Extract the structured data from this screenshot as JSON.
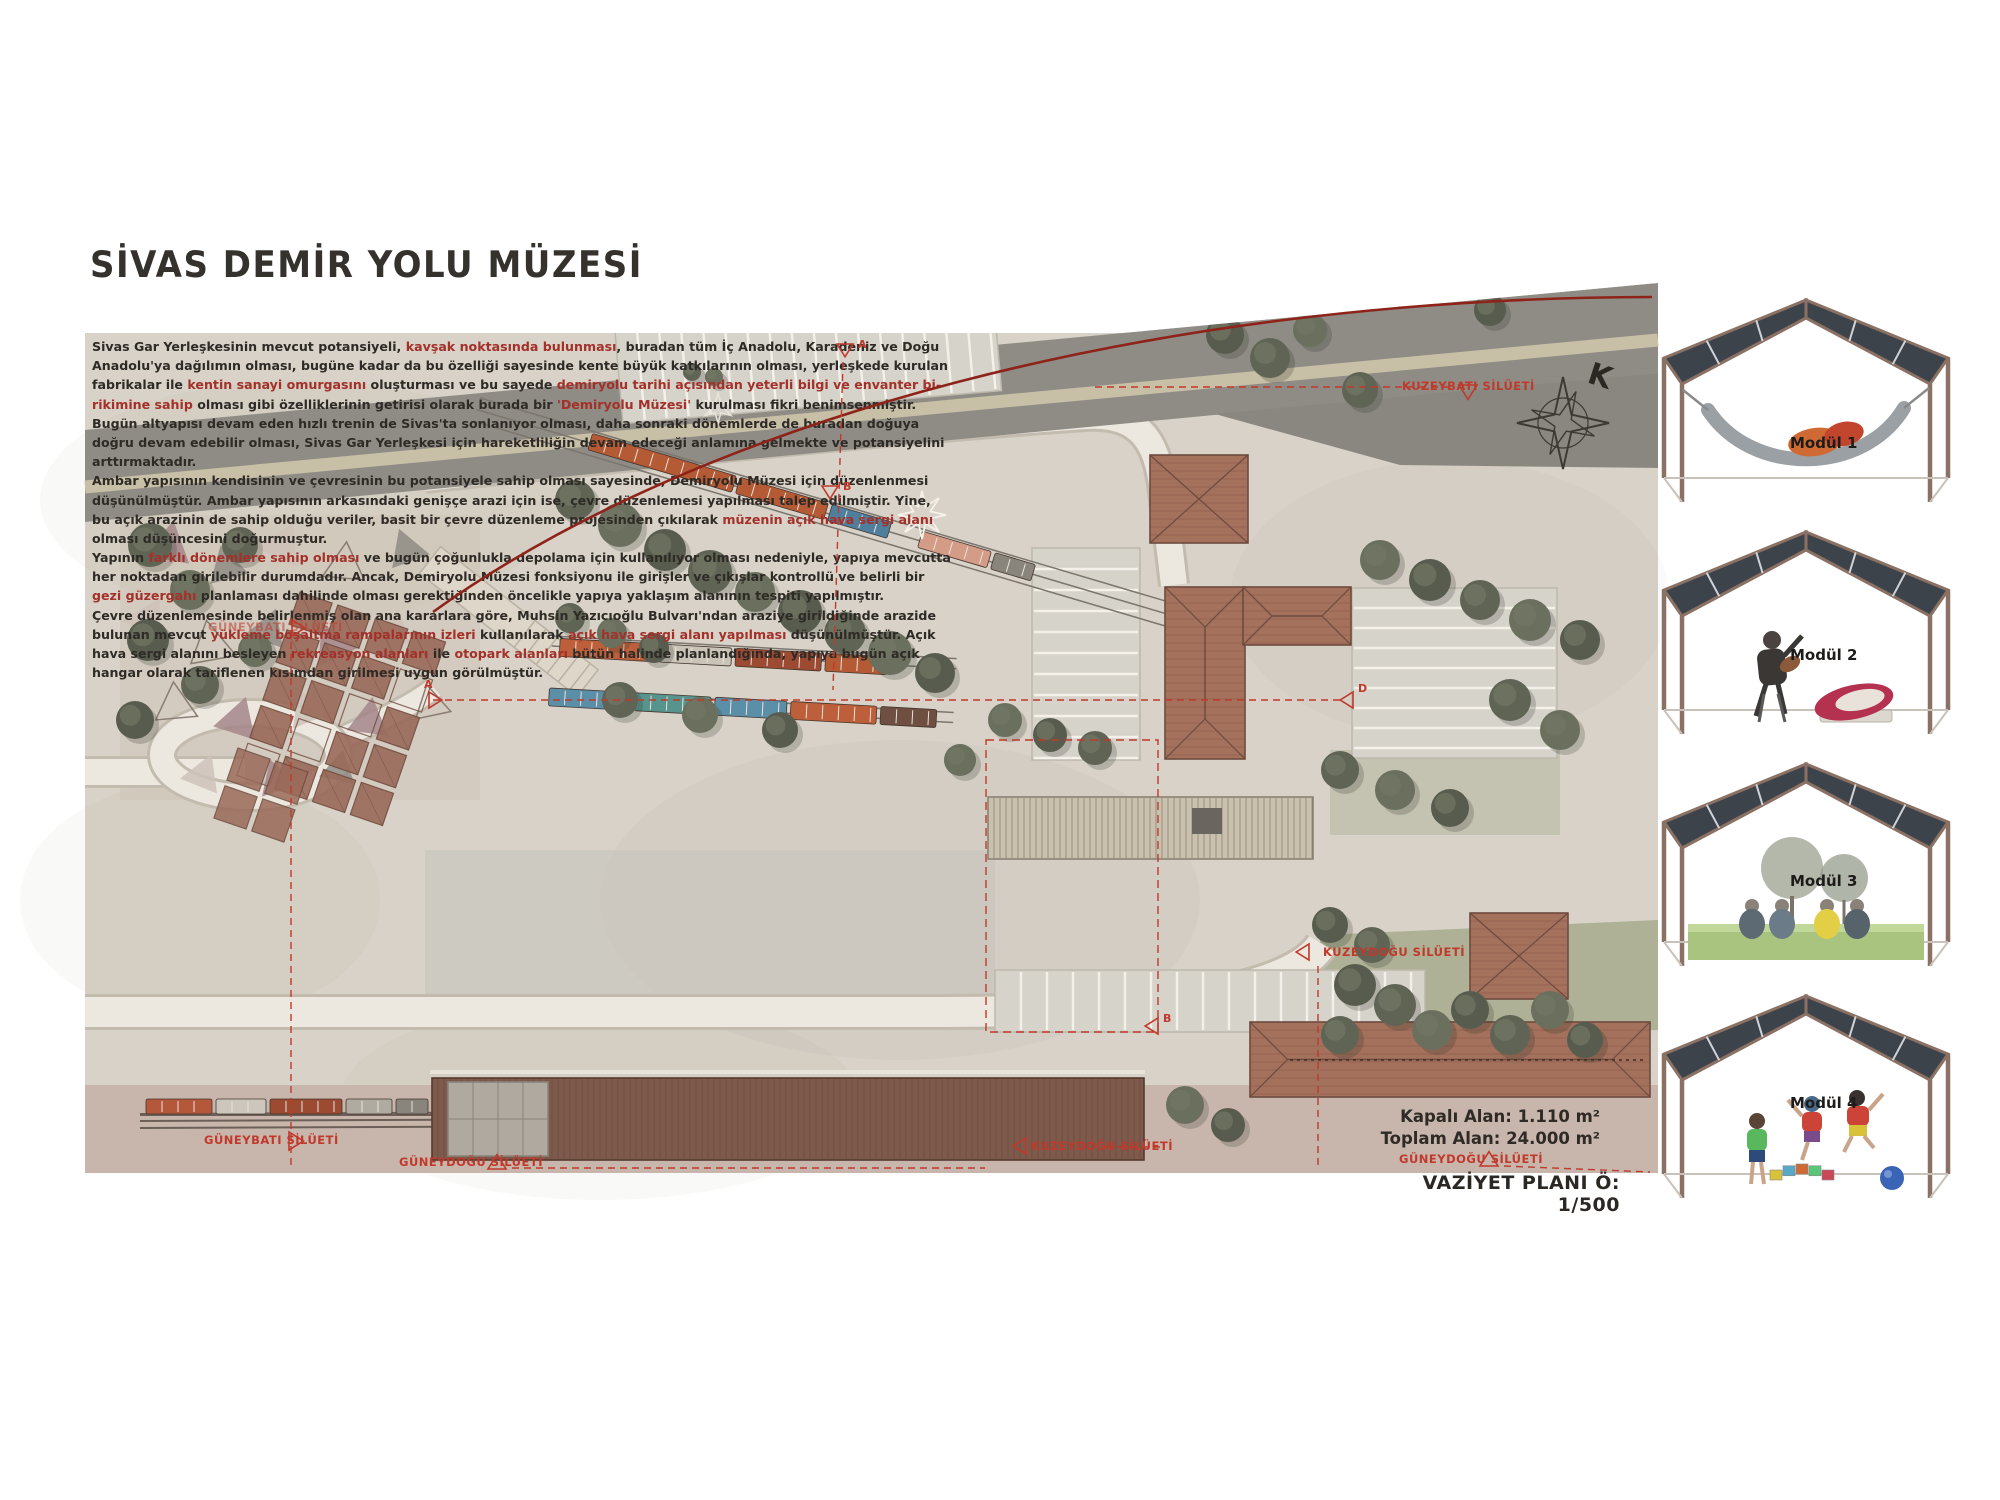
{
  "page": {
    "title": "SİVAS DEMİR YOLU MÜZESİ"
  },
  "colors": {
    "paper": "#d8d2c8",
    "road_dark": "#8f8c85",
    "road_light": "#ece8e0",
    "annotation_red": "#c0392b",
    "curve_red": "#8e231a",
    "text_red": "#a33029",
    "text_black": "#2e2a26",
    "roof_brown": "#a4715c",
    "tree_green": "#5f6455"
  },
  "intro": {
    "lines": [
      [
        {
          "t": "Sivas Gar Yerleşkesinin mevcut potansiyeli, ",
          "red": false
        },
        {
          "t": "kavşak noktasında bulunması",
          "red": true
        },
        {
          "t": ", buradan tüm İç Anadolu, Karadeniz ve Doğu",
          "red": false
        }
      ],
      [
        {
          "t": "Anadolu'ya dağılımın olması, bugüne kadar da bu özelliği sayesinde kente büyük katkılarının olması, yerleşkede kurulan",
          "red": false
        }
      ],
      [
        {
          "t": "fabrikalar ile ",
          "red": false
        },
        {
          "t": "kentin sanayi omurgasını",
          "red": true
        },
        {
          "t": " oluşturması ve bu sayede ",
          "red": false
        },
        {
          "t": "demiryolu tarihi açısından yeterli bilgi ve envanter bi-",
          "red": true
        }
      ],
      [
        {
          "t": "rikimine sahip",
          "red": true
        },
        {
          "t": " olması gibi özelliklerinin getirisi olarak burada bir ",
          "red": false
        },
        {
          "t": "'Demiryolu Müzesi'",
          "red": true
        },
        {
          "t": " kurulması fikri benimsenmiştir.",
          "red": false
        }
      ],
      [
        {
          "t": "Bugün altyapısı devam eden hızlı trenin de Sivas'ta sonlanıyor olması, daha sonraki dönemlerde de buradan doğuya",
          "red": false
        }
      ],
      [
        {
          "t": "doğru devam edebilir olması, Sivas Gar Yerleşkesi için hareketliliğin devam edeceği anlamına gelmekte ve potansiyelini",
          "red": false
        }
      ],
      [
        {
          "t": "arttırmaktadır.",
          "red": false
        }
      ],
      [
        {
          "t": "Ambar yapısının kendisinin ve çevresinin bu potansiyele sahip olması sayesinde, Demiryolu Müzesi için düzenlenmesi",
          "red": false
        }
      ],
      [
        {
          "t": "düşünülmüştür. Ambar yapısının arkasındaki genişçe arazi için ise, çevre düzenlemesi yapılması talep edilmiştir. Yine,",
          "red": false
        }
      ],
      [
        {
          "t": "bu açık arazinin de sahip olduğu veriler, basit bir çevre düzenleme projesinden çıkılarak ",
          "red": false
        },
        {
          "t": "müzenin açık hava sergi alanı",
          "red": true
        }
      ],
      [
        {
          "t": "olması düşüncesini doğurmuştur.",
          "red": false
        }
      ],
      [
        {
          "t": "Yapının ",
          "red": false
        },
        {
          "t": "farklı dönemlere sahip olması",
          "red": true
        },
        {
          "t": " ve bugün çoğunlukla depolama için kullanılıyor olması nedeniyle, yapıya mevcutta",
          "red": false
        }
      ],
      [
        {
          "t": "her noktadan girilebilir durumdadır. Ancak, Demiryolu Müzesi fonksiyonu ile girişler ve çıkışlar kontrollü ve belirli bir",
          "red": false
        }
      ],
      [
        {
          "t": "gezi güzergahı",
          "red": true
        },
        {
          "t": " planlaması dahilinde olması gerektiğinden öncelikle yapıya yaklaşım alanının tespiti yapılmıştır.",
          "red": false
        }
      ],
      [
        {
          "t": "Çevre düzenlemesinde belirlenmiş olan ana kararlara göre, Muhsin Yazıcıoğlu Bulvarı'ndan araziye girildiğinde arazide",
          "red": false
        }
      ],
      [
        {
          "t": "bulunan mevcut ",
          "red": false
        },
        {
          "t": "yükleme boşaltma rampalarının izleri",
          "red": true
        },
        {
          "t": " kullanılarak ",
          "red": false
        },
        {
          "t": "açık hava sergi alanı yapılması",
          "red": true
        },
        {
          "t": " düşünülmüştür. Açık",
          "red": false
        }
      ],
      [
        {
          "t": "hava sergi alanını besleyen ",
          "red": false
        },
        {
          "t": "rekreasyon alanları",
          "red": true
        },
        {
          "t": " ile ",
          "red": false
        },
        {
          "t": "otopark alanları",
          "red": true
        },
        {
          "t": " bütün halinde planlandığında, yapıya bugün açık",
          "red": false
        }
      ],
      [
        {
          "t": "hangar olarak tariflenen kısımdan girilmesi uygun görülmüştür.",
          "red": false
        }
      ]
    ]
  },
  "plan": {
    "compass_letter": "K",
    "silhouette_labels": {
      "kuzeybati": "KUZEYBATI SİLÜETİ",
      "guneybati": "GÜNEYBATI SİLÜETİ",
      "guneydogu": "GÜNEYDOĞU SİLÜETİ",
      "kuzeydogu": "KUZEYDOĞU SİLÜETİ"
    },
    "section_letters": [
      "A",
      "B",
      "D"
    ],
    "stats": [
      {
        "label": "Kapalı Alan:",
        "value": "1.110 m²"
      },
      {
        "label": "Toplam Alan:",
        "value": "24.000 m²"
      }
    ],
    "scale_note": "VAZİYET PLANI Ö: 1/500"
  },
  "modules": [
    {
      "label": "Modül 1",
      "scene": "hammock"
    },
    {
      "label": "Modül 2",
      "scene": "musician"
    },
    {
      "label": "Modül 3",
      "scene": "picnic"
    },
    {
      "label": "Modül 4",
      "scene": "children"
    }
  ]
}
